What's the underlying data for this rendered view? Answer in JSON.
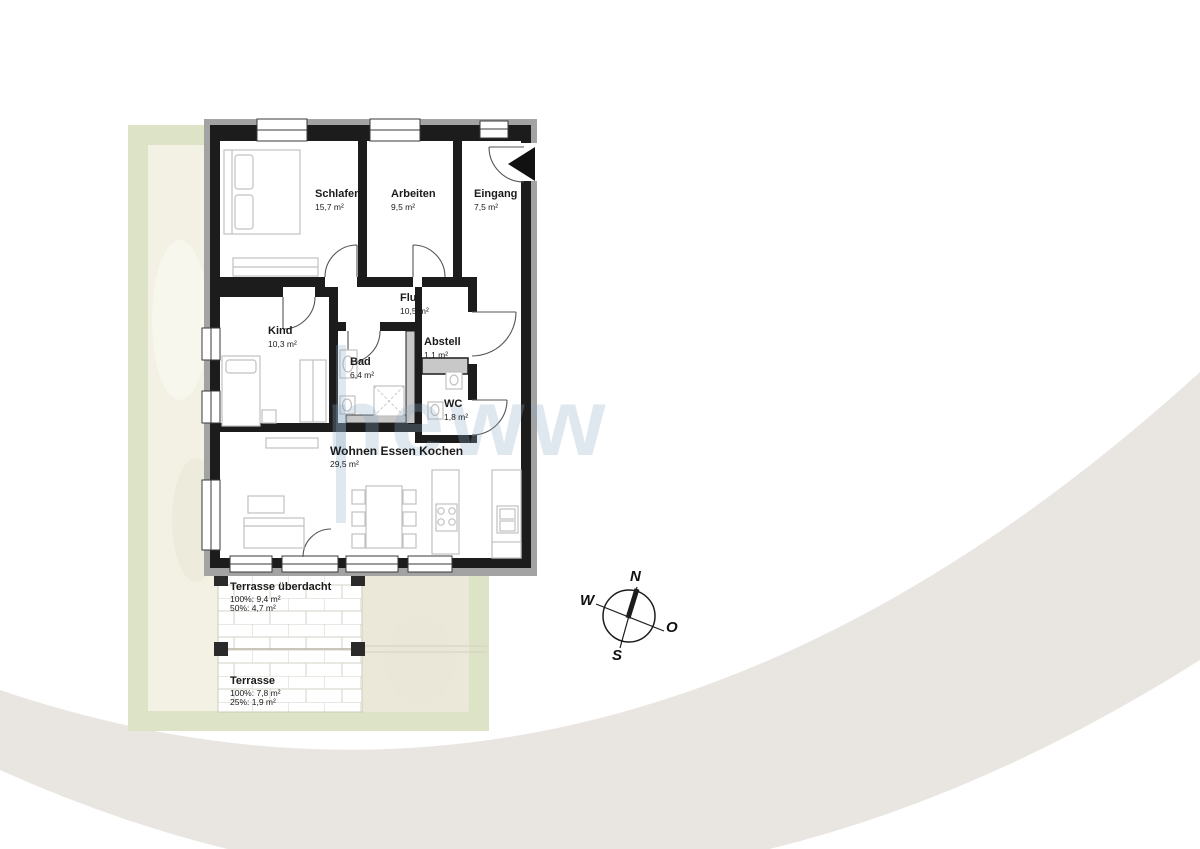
{
  "rooms": [
    {
      "name": "Schlafen",
      "area": "15,7 m²"
    },
    {
      "name": "Arbeiten",
      "area": "9,5 m²"
    },
    {
      "name": "Eingang",
      "area": "7,5 m²"
    },
    {
      "name": "Flur",
      "area": "10,5 m²"
    },
    {
      "name": "Kind",
      "area": "10,3 m²"
    },
    {
      "name": "Bad",
      "area": "6,4 m²"
    },
    {
      "name": "Abstell",
      "area": "1,1 m²"
    },
    {
      "name": "WC",
      "area": "1,8 m²"
    },
    {
      "name": "Wohnen Essen Kochen",
      "area": "29,5 m²"
    }
  ],
  "outdoor": [
    {
      "name": "Terrasse überdacht",
      "lines": [
        "100%: 9,4 m²",
        "50%: 4,7 m²"
      ]
    },
    {
      "name": "Terrasse",
      "lines": [
        "100%: 7,8 m²",
        "25%: 1,9 m²"
      ]
    }
  ],
  "compass": {
    "n": "N",
    "o": "O",
    "s": "S",
    "w": "W"
  },
  "watermark": {
    "text": "neww"
  },
  "colors": {
    "wall": "#1c1c1c",
    "wall_outline": "#a3a3a3",
    "plumbing_wall": "#c8c8c8",
    "plot_green": "#dce3c6",
    "plot_inner": "#f2f1e4",
    "terrace_joint": "#d6d2c4",
    "swoosh": "#e9e6e2",
    "watermark_blue": "#8caac5",
    "furniture": "#c0c0c0"
  }
}
